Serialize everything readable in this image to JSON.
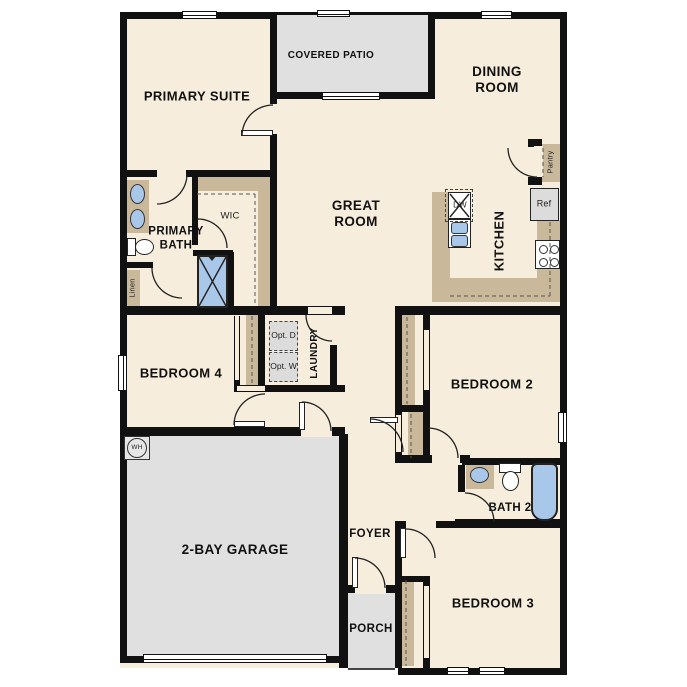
{
  "plan": {
    "rooms": {
      "primary_suite": "PRIMARY SUITE",
      "covered_patio": "COVERED PATIO",
      "dining_room": "DINING ROOM",
      "great_room": "GREAT ROOM",
      "kitchen": "KITCHEN",
      "primary_bath": "PRIMARY BATH",
      "wic": "WIC",
      "bedroom_4": "BEDROOM 4",
      "laundry": "LAUNDRY",
      "bedroom_2": "BEDROOM 2",
      "bath_2": "BATH 2",
      "garage": "2-BAY GARAGE",
      "foyer": "FOYER",
      "porch": "PORCH",
      "bedroom_3": "BEDROOM 3"
    },
    "fixtures": {
      "linen": "Linen",
      "pantry": "Pantry",
      "ref": "Ref",
      "dw": "DW",
      "wh": "WH",
      "opt_dryer": "Opt. D",
      "opt_washer": "Opt. W"
    },
    "colors": {
      "background": "#ffffff",
      "floor": "#f6eddc",
      "wall": "#111111",
      "exterior_concrete": "#e0e0e0",
      "casework_tan": "#c9b89a",
      "plumbing_blue": "#a9c7e9",
      "appliance_gray": "#dcdcdc"
    }
  }
}
